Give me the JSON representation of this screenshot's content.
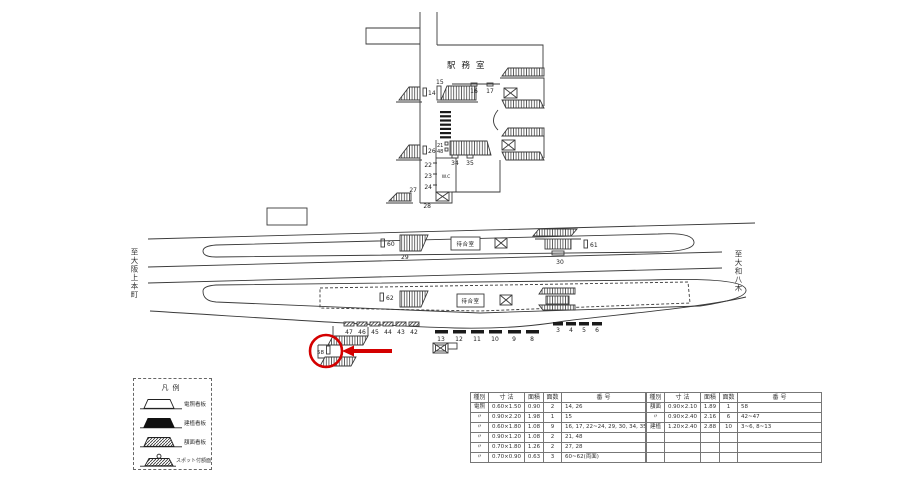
{
  "diagram": {
    "station_office_label": "駅務室",
    "waiting_room_upper": "待合室",
    "waiting_room_lower": "待合室",
    "wc_label": "W.C",
    "direction_left": "至大阪上本町",
    "direction_right": "至大和八木",
    "labels": {
      "n14": "14",
      "n15": "15",
      "n16": "16",
      "n17": "17",
      "n21": "21",
      "n48": "48",
      "n22": "22",
      "n23": "23",
      "n24": "24",
      "n26": "26",
      "n27": "27",
      "n28": "28",
      "n34": "34",
      "n35": "35",
      "n29": "29",
      "n30": "30",
      "n60": "60",
      "n61": "61",
      "n62": "62",
      "n58": "58"
    },
    "sign_rows": {
      "row_a": [
        "47",
        "46",
        "45",
        "44",
        "43",
        "42"
      ],
      "row_b": [
        "13",
        "12",
        "11",
        "10",
        "9",
        "8"
      ],
      "row_c": [
        "3",
        "4",
        "5",
        "6"
      ]
    }
  },
  "legend": {
    "title": "凡例",
    "items": [
      "電照看板",
      "建植看板",
      "額面看板",
      "スポット付額面"
    ]
  },
  "table": {
    "headers": [
      "種別",
      "寸 法",
      "面積",
      "面数",
      "番 号"
    ],
    "left_rows": [
      [
        "電照",
        "0.60×1.50",
        "0.90",
        "2",
        "14, 26"
      ],
      [
        "〃",
        "0.90×2.20",
        "1.98",
        "1",
        "15"
      ],
      [
        "〃",
        "0.60×1.80",
        "1.08",
        "9",
        "16, 17, 22~24, 29, 30, 34, 35"
      ],
      [
        "〃",
        "0.90×1.20",
        "1.08",
        "2",
        "21, 48"
      ],
      [
        "〃",
        "0.70×1.80",
        "1.26",
        "2",
        "27, 28"
      ],
      [
        "〃",
        "0.70×0.90",
        "0.63",
        "3",
        "60~62(両面)"
      ]
    ],
    "right_rows": [
      [
        "額面",
        "0.90×2.10",
        "1.89",
        "1",
        "58"
      ],
      [
        "〃",
        "0.90×2.40",
        "2.16",
        "6",
        "42~47"
      ],
      [
        "建植",
        "1.20×2.40",
        "2.88",
        "10",
        "3~6, 8~13"
      ],
      [
        "",
        "",
        "",
        "",
        ""
      ],
      [
        "",
        "",
        "",
        "",
        ""
      ],
      [
        "",
        "",
        "",
        "",
        ""
      ]
    ]
  },
  "colors": {
    "annotation_red": "#d40000",
    "line": "#3a3a3a"
  }
}
